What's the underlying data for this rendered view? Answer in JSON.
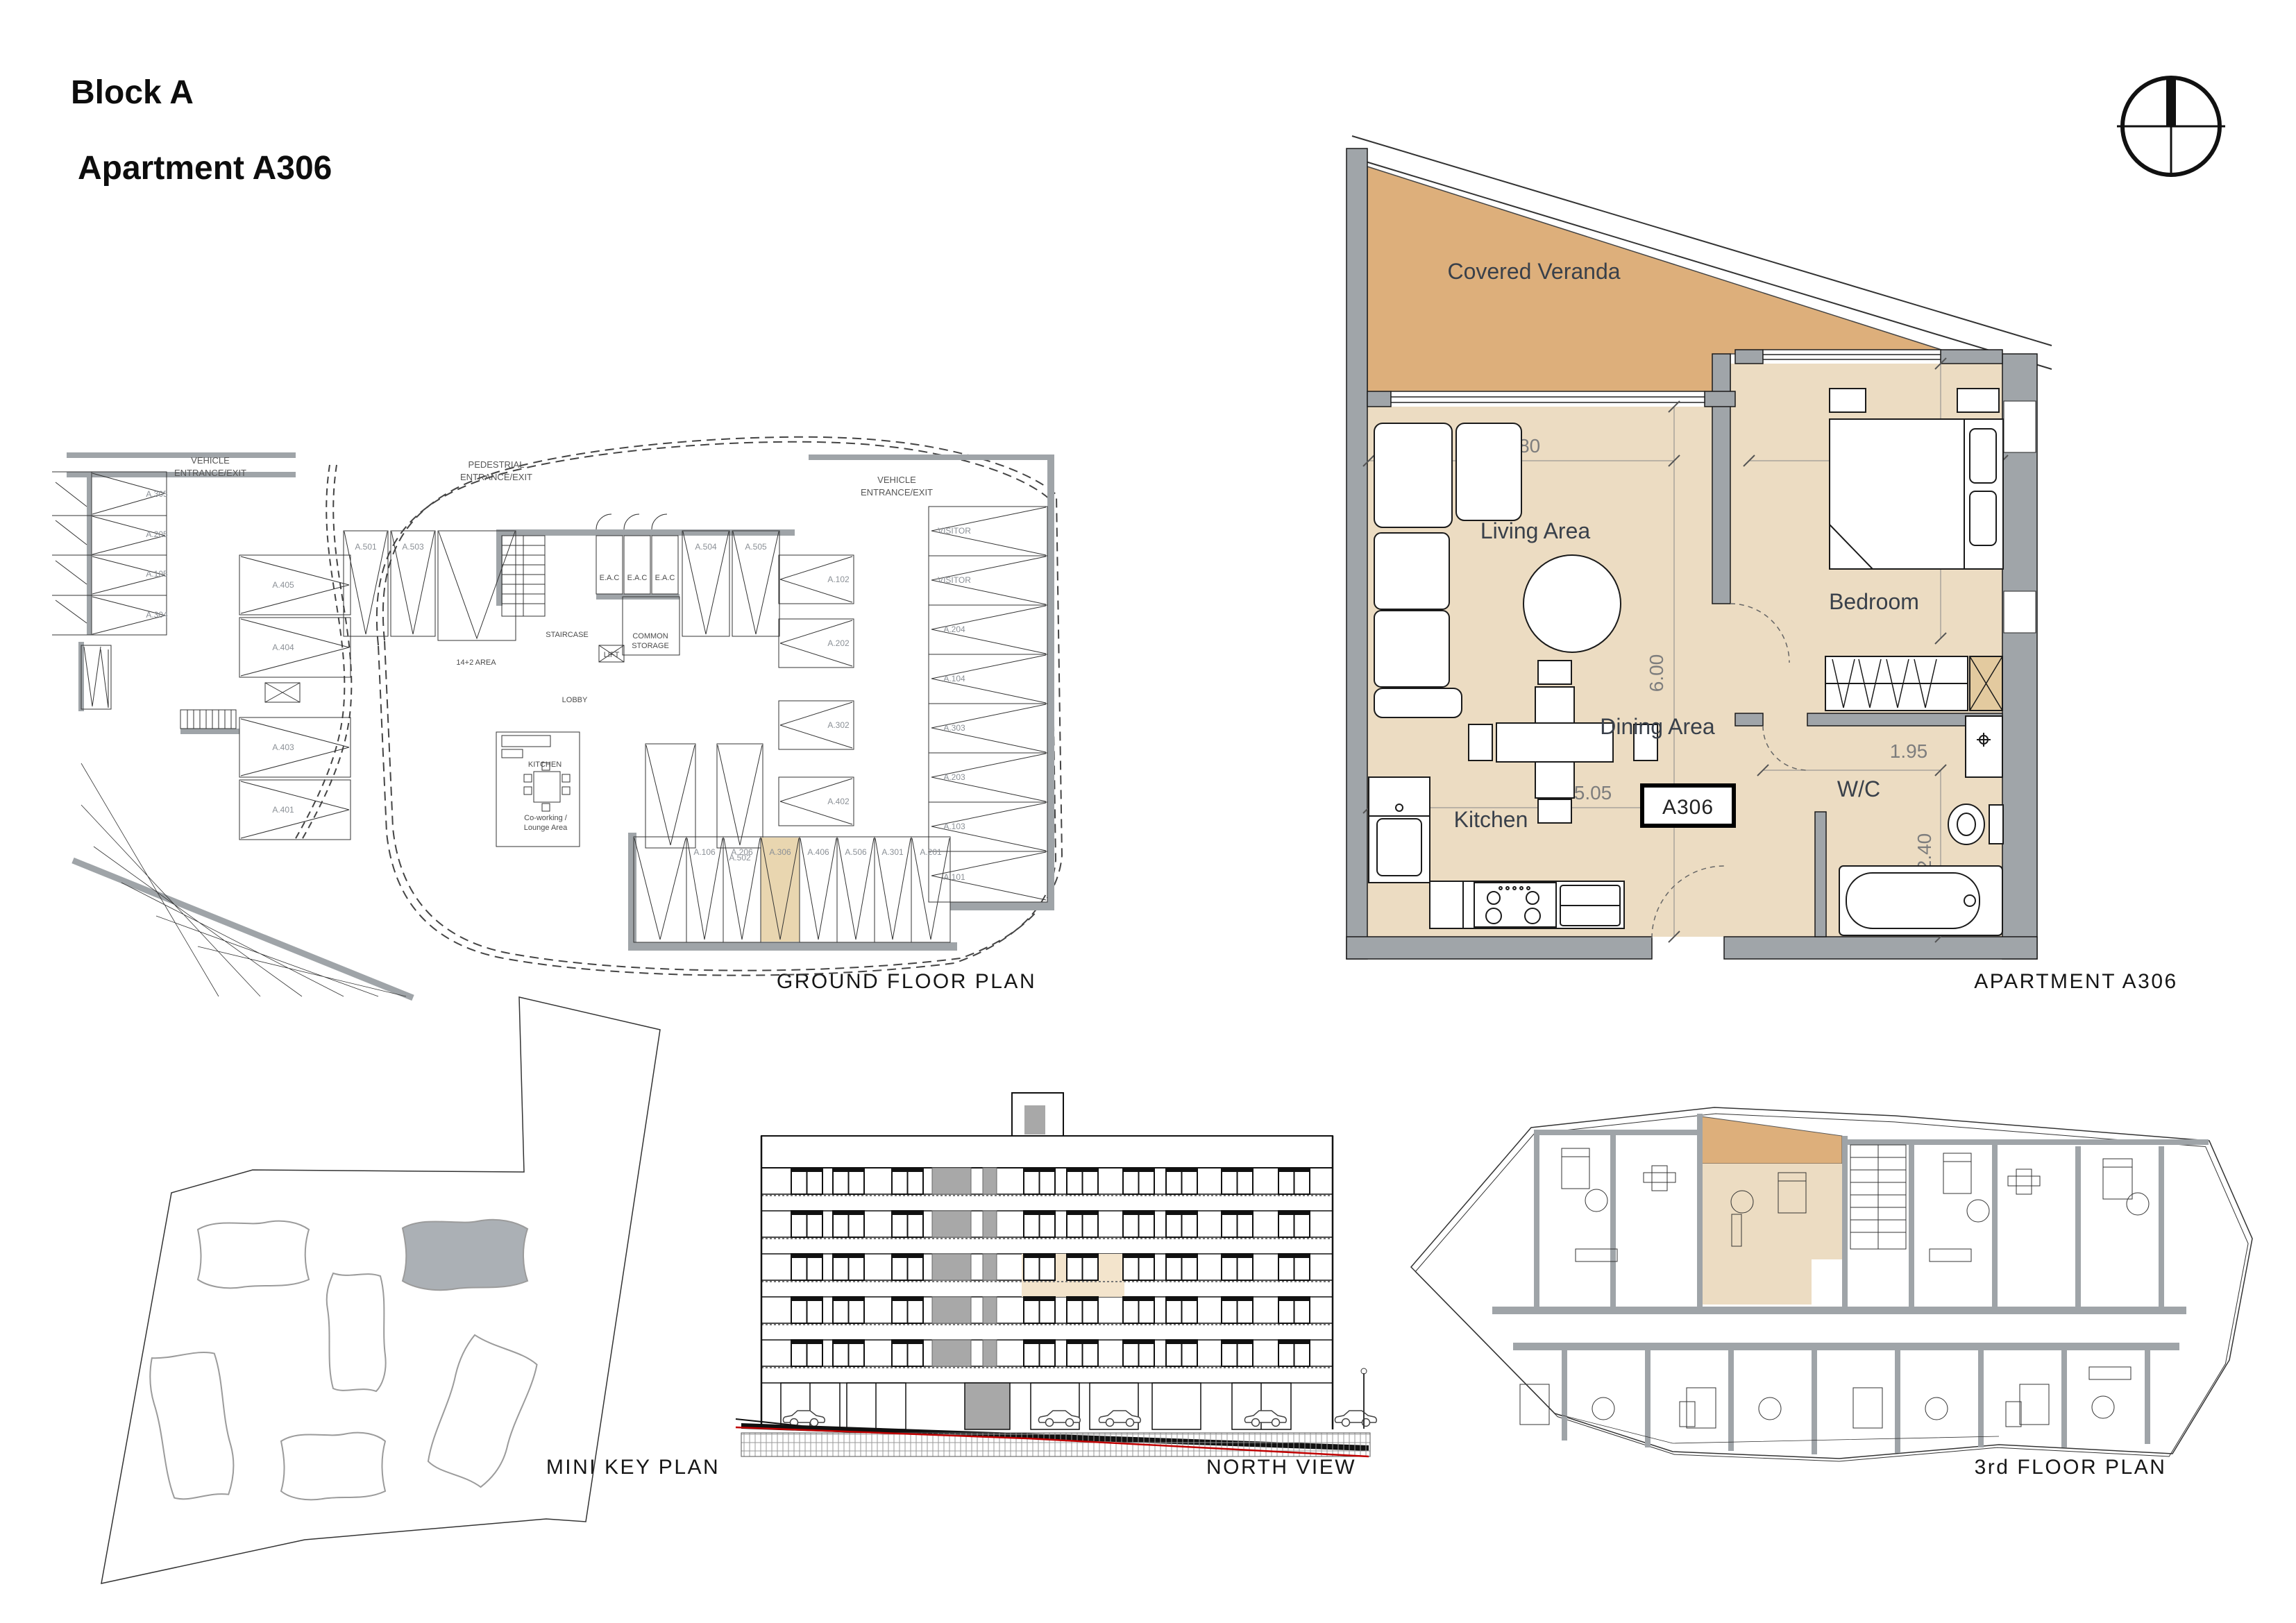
{
  "header": {
    "block": "Block A",
    "apartment": "Apartment A306"
  },
  "captions": {
    "ground_floor": "GROUND FLOOR PLAN",
    "apartment": "APARTMENT A306",
    "mini_key": "MINI KEY PLAN",
    "north_view": "NORTH VIEW",
    "third_floor": "3rd FLOOR PLAN"
  },
  "apartment_plan": {
    "unit_tag": "A306",
    "rooms": {
      "veranda": "Covered Veranda",
      "living": "Living Area",
      "dining": "Dining Area",
      "kitchen": "Kitchen",
      "bedroom": "Bedroom",
      "wc": "W/C"
    },
    "dimensions": {
      "living_width": "3.80",
      "living_depth": "6.00",
      "hall_width": "5.05",
      "bedroom_width": "3.20",
      "bedroom_depth": "3.40",
      "wc_width": "1.95",
      "wc_depth": "2.40"
    }
  },
  "ground_floor": {
    "labels": {
      "vehicle_l1": "VEHICLE",
      "vehicle_l2": "ENTRANCE/EXIT",
      "vehicle2_l1": "VEHICLE",
      "vehicle2_l2": "ENTRANCE/EXIT",
      "pedestrian_l1": "PEDESTRIAL",
      "pedestrian_l2": "ENTRANCE/EXIT",
      "area": "14+2 AREA",
      "staircase": "STAIRCASE",
      "eac": [
        "E.A.C",
        "E.A.C",
        "E.A.C"
      ],
      "storage_l1": "COMMON",
      "storage_l2": "STORAGE",
      "lobby": "LOBBY",
      "lift": "LIFT",
      "kitchen": "KITCHEN",
      "cowork_l1": "Co-working /",
      "cowork_l2": "Lounge Area"
    },
    "left_column": [
      "A.305",
      "A.205",
      "A.105",
      "A.304"
    ],
    "mid_column": [
      "A.405",
      "A.404",
      "A.403",
      "A.401"
    ],
    "top_row": [
      "A.501",
      "A.503",
      "A.504",
      "A.505"
    ],
    "inner_column": [
      "A.102",
      "A.202",
      "A.302",
      "A.402"
    ],
    "a502": "A.502",
    "right_column": [
      "VISITOR",
      "VISITOR",
      "A.204",
      "A.104",
      "A.303",
      "A.203",
      "A.103",
      "A.101"
    ],
    "bottom_row": [
      "A.106",
      "A.206",
      "A.306",
      "A.406",
      "A.506",
      "A.301",
      "A.201"
    ],
    "highlighted_stall": "A.306"
  },
  "colors": {
    "veranda_tan": "#DDAF7B",
    "interior_tan": "#ECDCC2",
    "wall_gray": "#A0A5A9",
    "highlight_tan": "#F3E4CC",
    "stall_highlight": "#E9D6B0",
    "site_block_gray": "#ABB0B5",
    "ground_red": "#C00000"
  }
}
